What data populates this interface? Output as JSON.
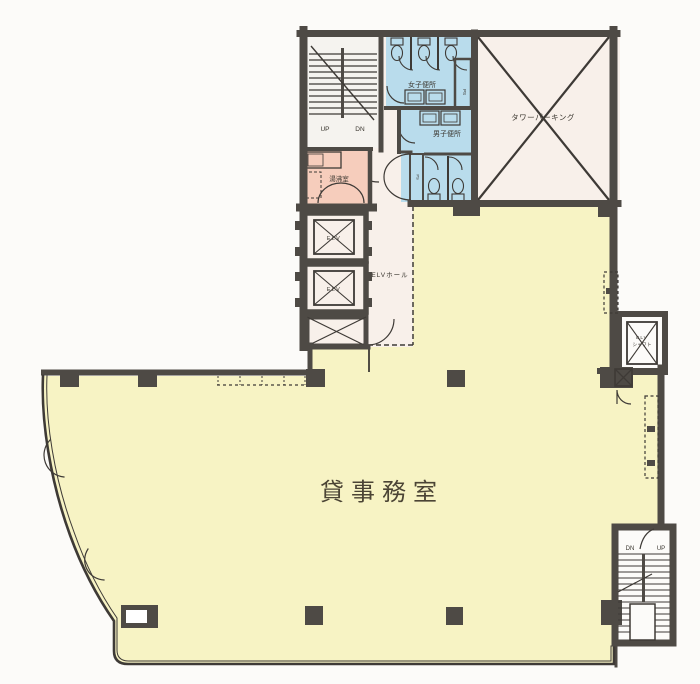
{
  "title": "office-floor-plan",
  "colors": {
    "office_fill": "#f7f3c4",
    "toilet_fill": "#b9dcec",
    "kitchenette_fill": "#f6cdbc",
    "hall_fill": "#f8f0ea",
    "stair_fill": "#f5f3ef",
    "counter_fill": "#cfe9f3",
    "wall": "#4e4a45",
    "background": "#fcfbf9",
    "line": "#3e3a36"
  },
  "labels": {
    "office": "貸事務室",
    "tower_parking": "タワーパーキング",
    "womens_toilet": "女子便所",
    "mens_toilet": "男子便所",
    "kitchenette": "湯沸室",
    "elevator_hall": "ELVホール",
    "elevator": "ELV",
    "elevator_shaft_l1": "ELV",
    "elevator_shaft_l2": "シャフト",
    "pipe_space": "PS",
    "up": "UP",
    "down": "DN"
  }
}
